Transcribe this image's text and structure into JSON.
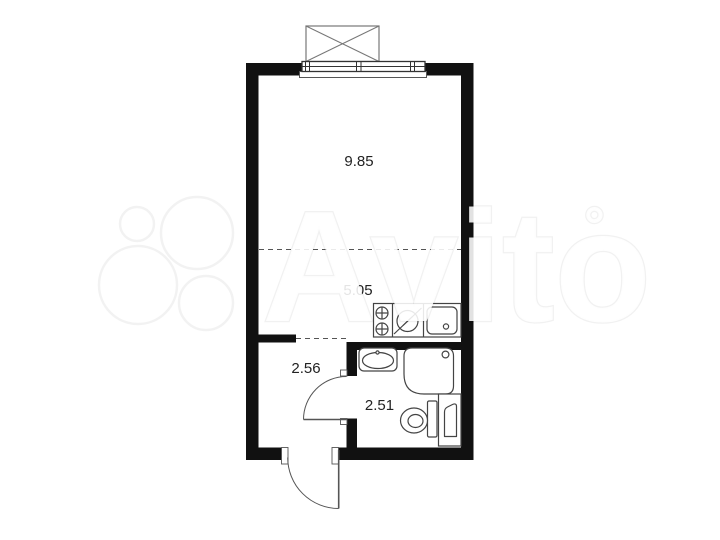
{
  "watermark": {
    "brand_text": "Avito",
    "trademark_mark": "°"
  },
  "plan": {
    "rooms": [
      {
        "name": "living-room",
        "area_label": "9.85"
      },
      {
        "name": "kitchen-zone",
        "area_label": "5.05"
      },
      {
        "name": "hallway",
        "area_label": "2.56"
      },
      {
        "name": "bathroom",
        "area_label": "2.51"
      }
    ]
  },
  "colors": {
    "background": "#ffffff",
    "wall": "#111111",
    "fixture_line": "#444444",
    "door_line": "#555555",
    "label_text": "#222222",
    "watermark_outline": "#ededed"
  }
}
